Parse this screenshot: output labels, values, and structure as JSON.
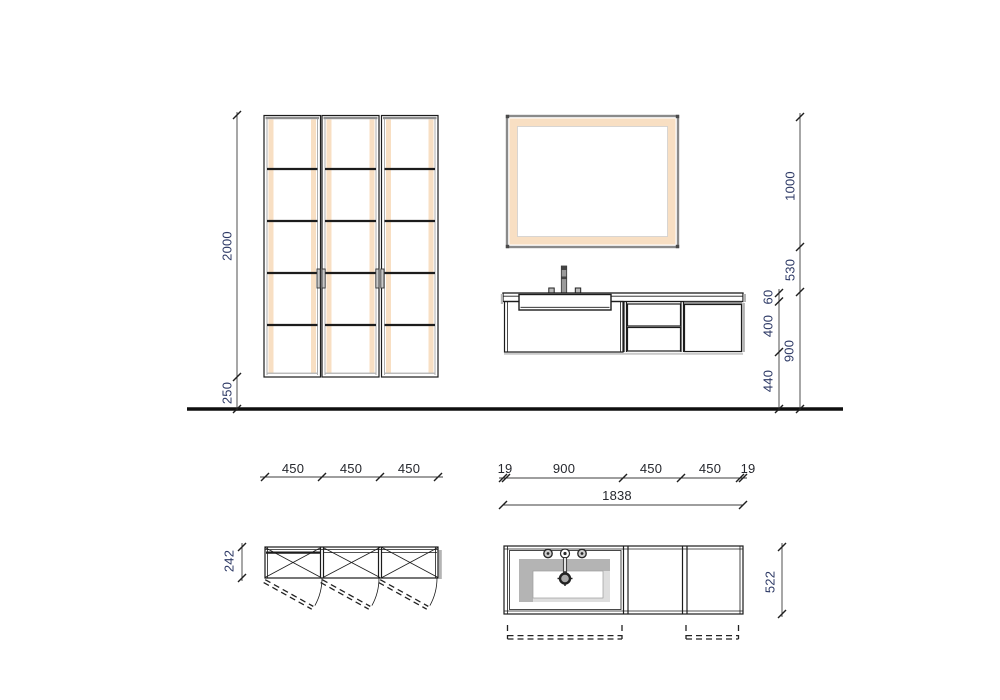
{
  "drawing": {
    "description": "bathroom furniture technical drawing, front elevation and plan views"
  },
  "dimensions": {
    "elevation": {
      "cabinet_height": "2000",
      "cabinet_bottom_clearance": "250",
      "mirror_height": "1000",
      "mirror_to_counter_gap": "530",
      "counter_height_from_floor": "900",
      "countertop_thickness": "60",
      "vanity_unit_height": "400",
      "vanity_floor_clearance": "440"
    },
    "plan_cabinets": {
      "unit_width_1": "450",
      "unit_width_2": "450",
      "unit_width_3": "450",
      "depth": "242"
    },
    "plan_vanity": {
      "edge_left": "19",
      "sink_section_width": "900",
      "middle_section_width": "450",
      "right_section_width": "450",
      "edge_right": "19",
      "total_width": "1838",
      "depth": "522"
    }
  },
  "colors": {
    "line": "#1c1c1c",
    "peach": "#f8dfc3",
    "frame_gray": "#8f8f8f",
    "shadow_gray": "#b4b4b4",
    "light_gray": "#dedede",
    "dim_text": "#26282e",
    "dim_text_rotated": "#2e3a66",
    "dim_line": "#3c3c3c",
    "background": "#ffffff"
  }
}
